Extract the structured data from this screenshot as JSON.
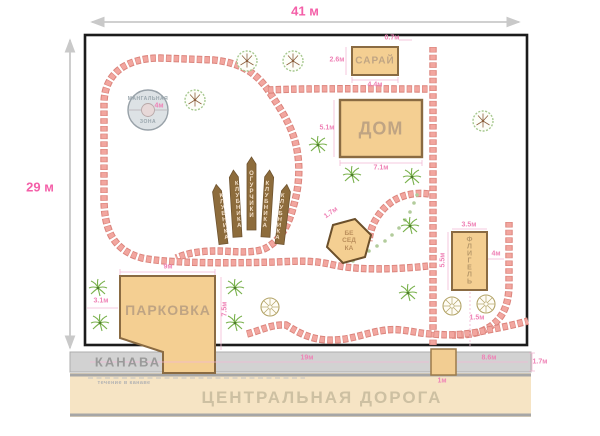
{
  "plan": {
    "width_label": "41 м",
    "height_label": "29 м"
  },
  "bbq_zone": {
    "name_top": "МАНГАЛЬНАЯ",
    "name_bottom": "ЗОНА",
    "diameter": "4м"
  },
  "shed": {
    "label": "САРАЙ",
    "dim_top": "0.7м",
    "dim_left": "2.6м",
    "dim_bottom": "4.4м"
  },
  "house": {
    "label": "ДОМ",
    "dim_left": "5.1м",
    "dim_bottom": "7.1м"
  },
  "beds": [
    {
      "label": "КЛУБНИКА"
    },
    {
      "label": "КЛУБНИКА"
    },
    {
      "label": "ОГУРЧИКИ"
    },
    {
      "label": "КЛУБНИКА"
    },
    {
      "label": "КЛУБНИКА"
    }
  ],
  "gazebo": {
    "label": "БЕ\nСЕД\nКА",
    "dim": "1.7м"
  },
  "annex": {
    "label": "ФЛИГЕЛЬ",
    "dim_top": "3.5м",
    "dim_left": "5.5м",
    "dim_right": "4м",
    "dim_bottom": "1.5м"
  },
  "parking": {
    "label": "ПАРКОВКА",
    "dim_top": "9м",
    "dim_left": "3.1м",
    "dim_right": "7.5м"
  },
  "ditch": {
    "label": "КАНАВА",
    "flow_label": "течение в канаве",
    "dim_left": "19м",
    "dim_bridge": "1м",
    "dim_right": "8.6м",
    "dim_width": "1.7м"
  },
  "road": {
    "label": "ЦЕНТРАЛЬНАЯ ДОРОГА"
  },
  "colors": {
    "accent_pink": "#f45fa8",
    "dim_pink": "#ef82b6",
    "path_brick": "#f2a69f",
    "building_fill": "#f4cf92",
    "building_border": "#8a6b42",
    "bed_fill": "#8d6c3c",
    "ditch_fill": "#d2d2d2",
    "road_fill": "#f6e4c4",
    "tree_green": "#a6c88f",
    "fence": "#1b1b1b"
  }
}
